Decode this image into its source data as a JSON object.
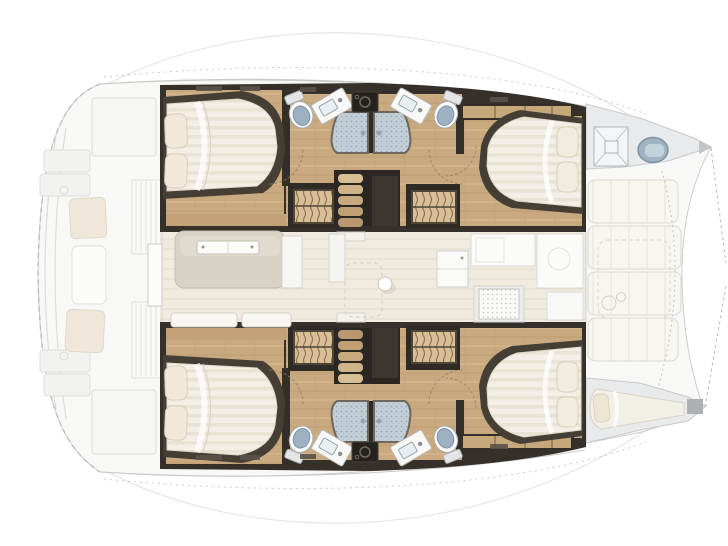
{
  "plan": {
    "type": "catamaran-yacht-floor-plan",
    "view": "overhead-deck-plan",
    "bow_direction": "right",
    "stern_direction": "left",
    "hulls": [
      {
        "id": "port-hull",
        "position": "top",
        "rooms": [
          {
            "name": "aft-double-cabin",
            "features": [
              "double-berth",
              "two-pillows",
              "foot-locker"
            ]
          },
          {
            "name": "aft-head",
            "fixtures": [
              "toilet",
              "washbasin",
              "shower-stall"
            ]
          },
          {
            "name": "forward-head",
            "fixtures": [
              "toilet",
              "washbasin",
              "shower-stall"
            ]
          },
          {
            "name": "forward-double-cabin",
            "features": [
              "double-berth",
              "two-pillows",
              "hanging-locker"
            ]
          },
          {
            "name": "companionway",
            "features": [
              "staircase",
              "grating-lockers"
            ]
          }
        ]
      },
      {
        "id": "starboard-hull",
        "position": "bottom",
        "rooms": [
          {
            "name": "aft-double-cabin",
            "features": [
              "double-berth",
              "two-pillows",
              "foot-locker"
            ]
          },
          {
            "name": "aft-head",
            "fixtures": [
              "toilet",
              "washbasin",
              "shower-stall"
            ]
          },
          {
            "name": "forward-head",
            "fixtures": [
              "toilet",
              "washbasin",
              "shower-stall"
            ]
          },
          {
            "name": "forward-double-cabin",
            "features": [
              "double-berth",
              "two-pillows",
              "hanging-locker"
            ]
          },
          {
            "name": "companionway",
            "features": [
              "staircase",
              "grating-lockers"
            ]
          }
        ]
      }
    ],
    "saloon": {
      "features": [
        "u-settee",
        "saloon-table",
        "aft-sliding-door",
        "mast-post",
        "galley-refrigerator",
        "galley-counter",
        "galley-sink",
        "galley-stove",
        "window-bench"
      ]
    },
    "foredeck": {
      "features": [
        "anchor-locker-hatch",
        "round-deck-hatch",
        "forward-cockpit-bench",
        "forward-table",
        "skipper-berth",
        "bow-tips",
        "trampoline-rigging"
      ]
    },
    "aft_cockpit": {
      "style": "ghosted",
      "features": [
        "transom-steps",
        "cockpit-seat-cushions",
        "cockpit-table",
        "louvered-lockers",
        "stern-arches"
      ]
    },
    "totals": {
      "double_cabins": 4,
      "bathrooms": 4,
      "toilets": 4,
      "washbasins": 4,
      "showers": 4,
      "skipper_berths": 1,
      "companionways": 2
    },
    "colors": {
      "floor_wood": "#C9AA80",
      "walls_dark": "#332E28",
      "mattress": "#F3EFE7",
      "pillow": "#F0E9DA",
      "shower_floor": "#C4CED6",
      "toilet_lid": "#9DB1C2",
      "saloon_floor": "#F0EADF",
      "deck_ghost": "#F8F8F7",
      "foredeck_gray": "#E9EAEB",
      "hatch_blue": "#9FB3C1",
      "grating_wood": "#D8BF97"
    }
  }
}
